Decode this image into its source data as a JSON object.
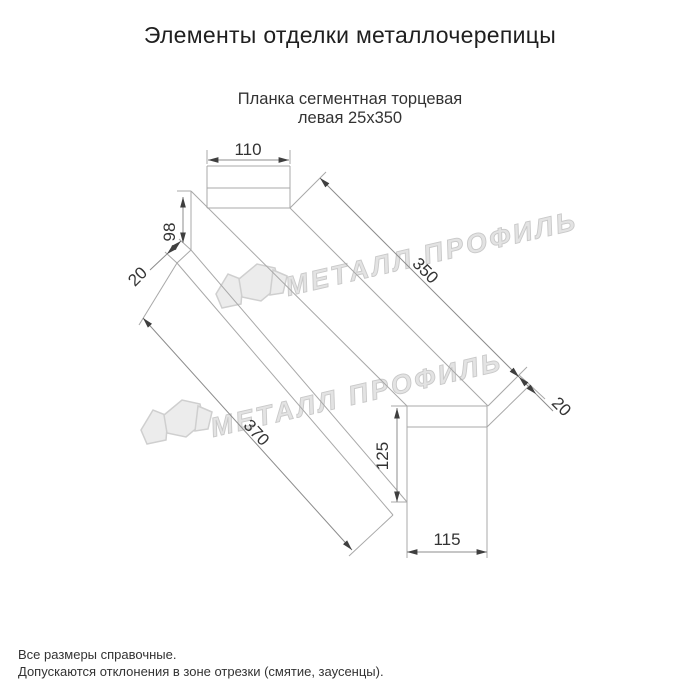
{
  "page": {
    "title": "Элементы отделки металлочерепицы",
    "subtitle_line1": "Планка сегментная торцевая",
    "subtitle_line2": "левая 25х350"
  },
  "drawing": {
    "type": "dimensioned technical drawing of a left segmental end (gable) trim strip",
    "dimensions": {
      "near_tab_width": "110",
      "near_side_height": "98",
      "near_hem": "20",
      "top_edge_length": "350",
      "far_hem": "20",
      "bottom_edge_length": "370",
      "far_tab_height": "125",
      "far_tab_width": "115"
    },
    "colors": {
      "geometry_line": "#a8a8a8",
      "dimension_line": "#8c8c8c",
      "dimension_text": "#333333",
      "watermark": "#e3e3e3"
    },
    "watermark_text": "МЕТАЛЛ ПРОФИЛЬ"
  },
  "footer": {
    "note1": "Все размеры справочные.",
    "note2": "Допускаются отклонения в зоне отрезки (смятие, заусенцы)."
  }
}
